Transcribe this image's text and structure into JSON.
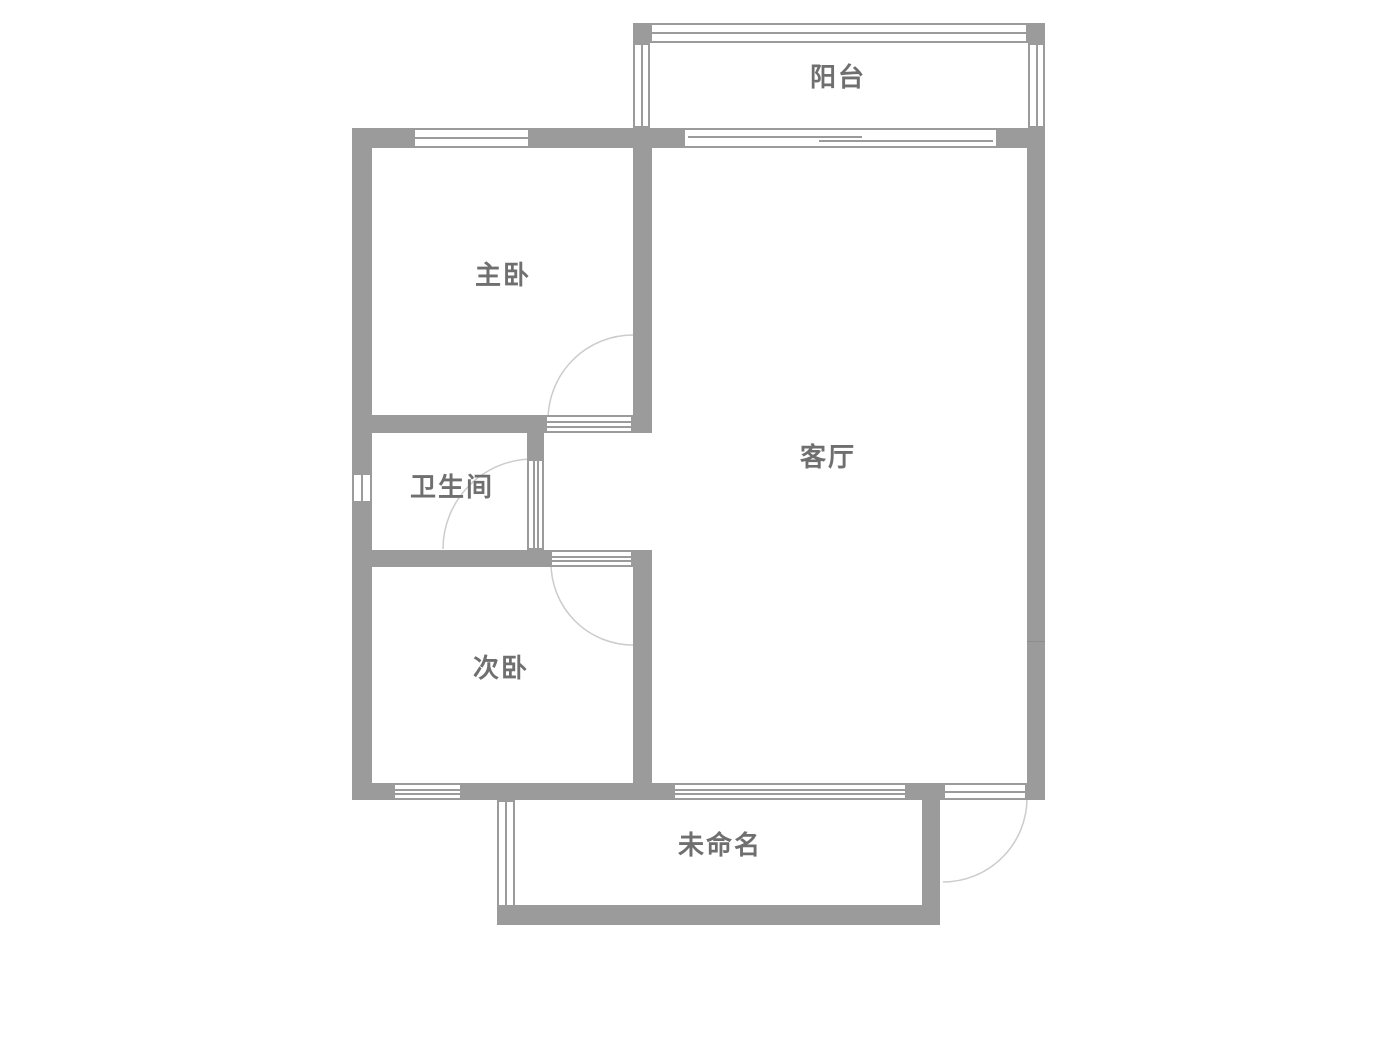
{
  "plan": {
    "type": "residential-floor-plan",
    "colors": {
      "wall": "#9b9b9b",
      "window_line": "#9b9b9b",
      "door_arc": "#cccccc",
      "label_text": "#6f6f6f",
      "background": "#ffffff"
    },
    "rooms": {
      "balcony": {
        "label": "阳台"
      },
      "master_bedroom": {
        "label": "主卧"
      },
      "bathroom": {
        "label": "卫生间"
      },
      "second_bedroom": {
        "label": "次卧"
      },
      "living_room": {
        "label": "客厅"
      },
      "unnamed": {
        "label": "未命名"
      }
    }
  }
}
